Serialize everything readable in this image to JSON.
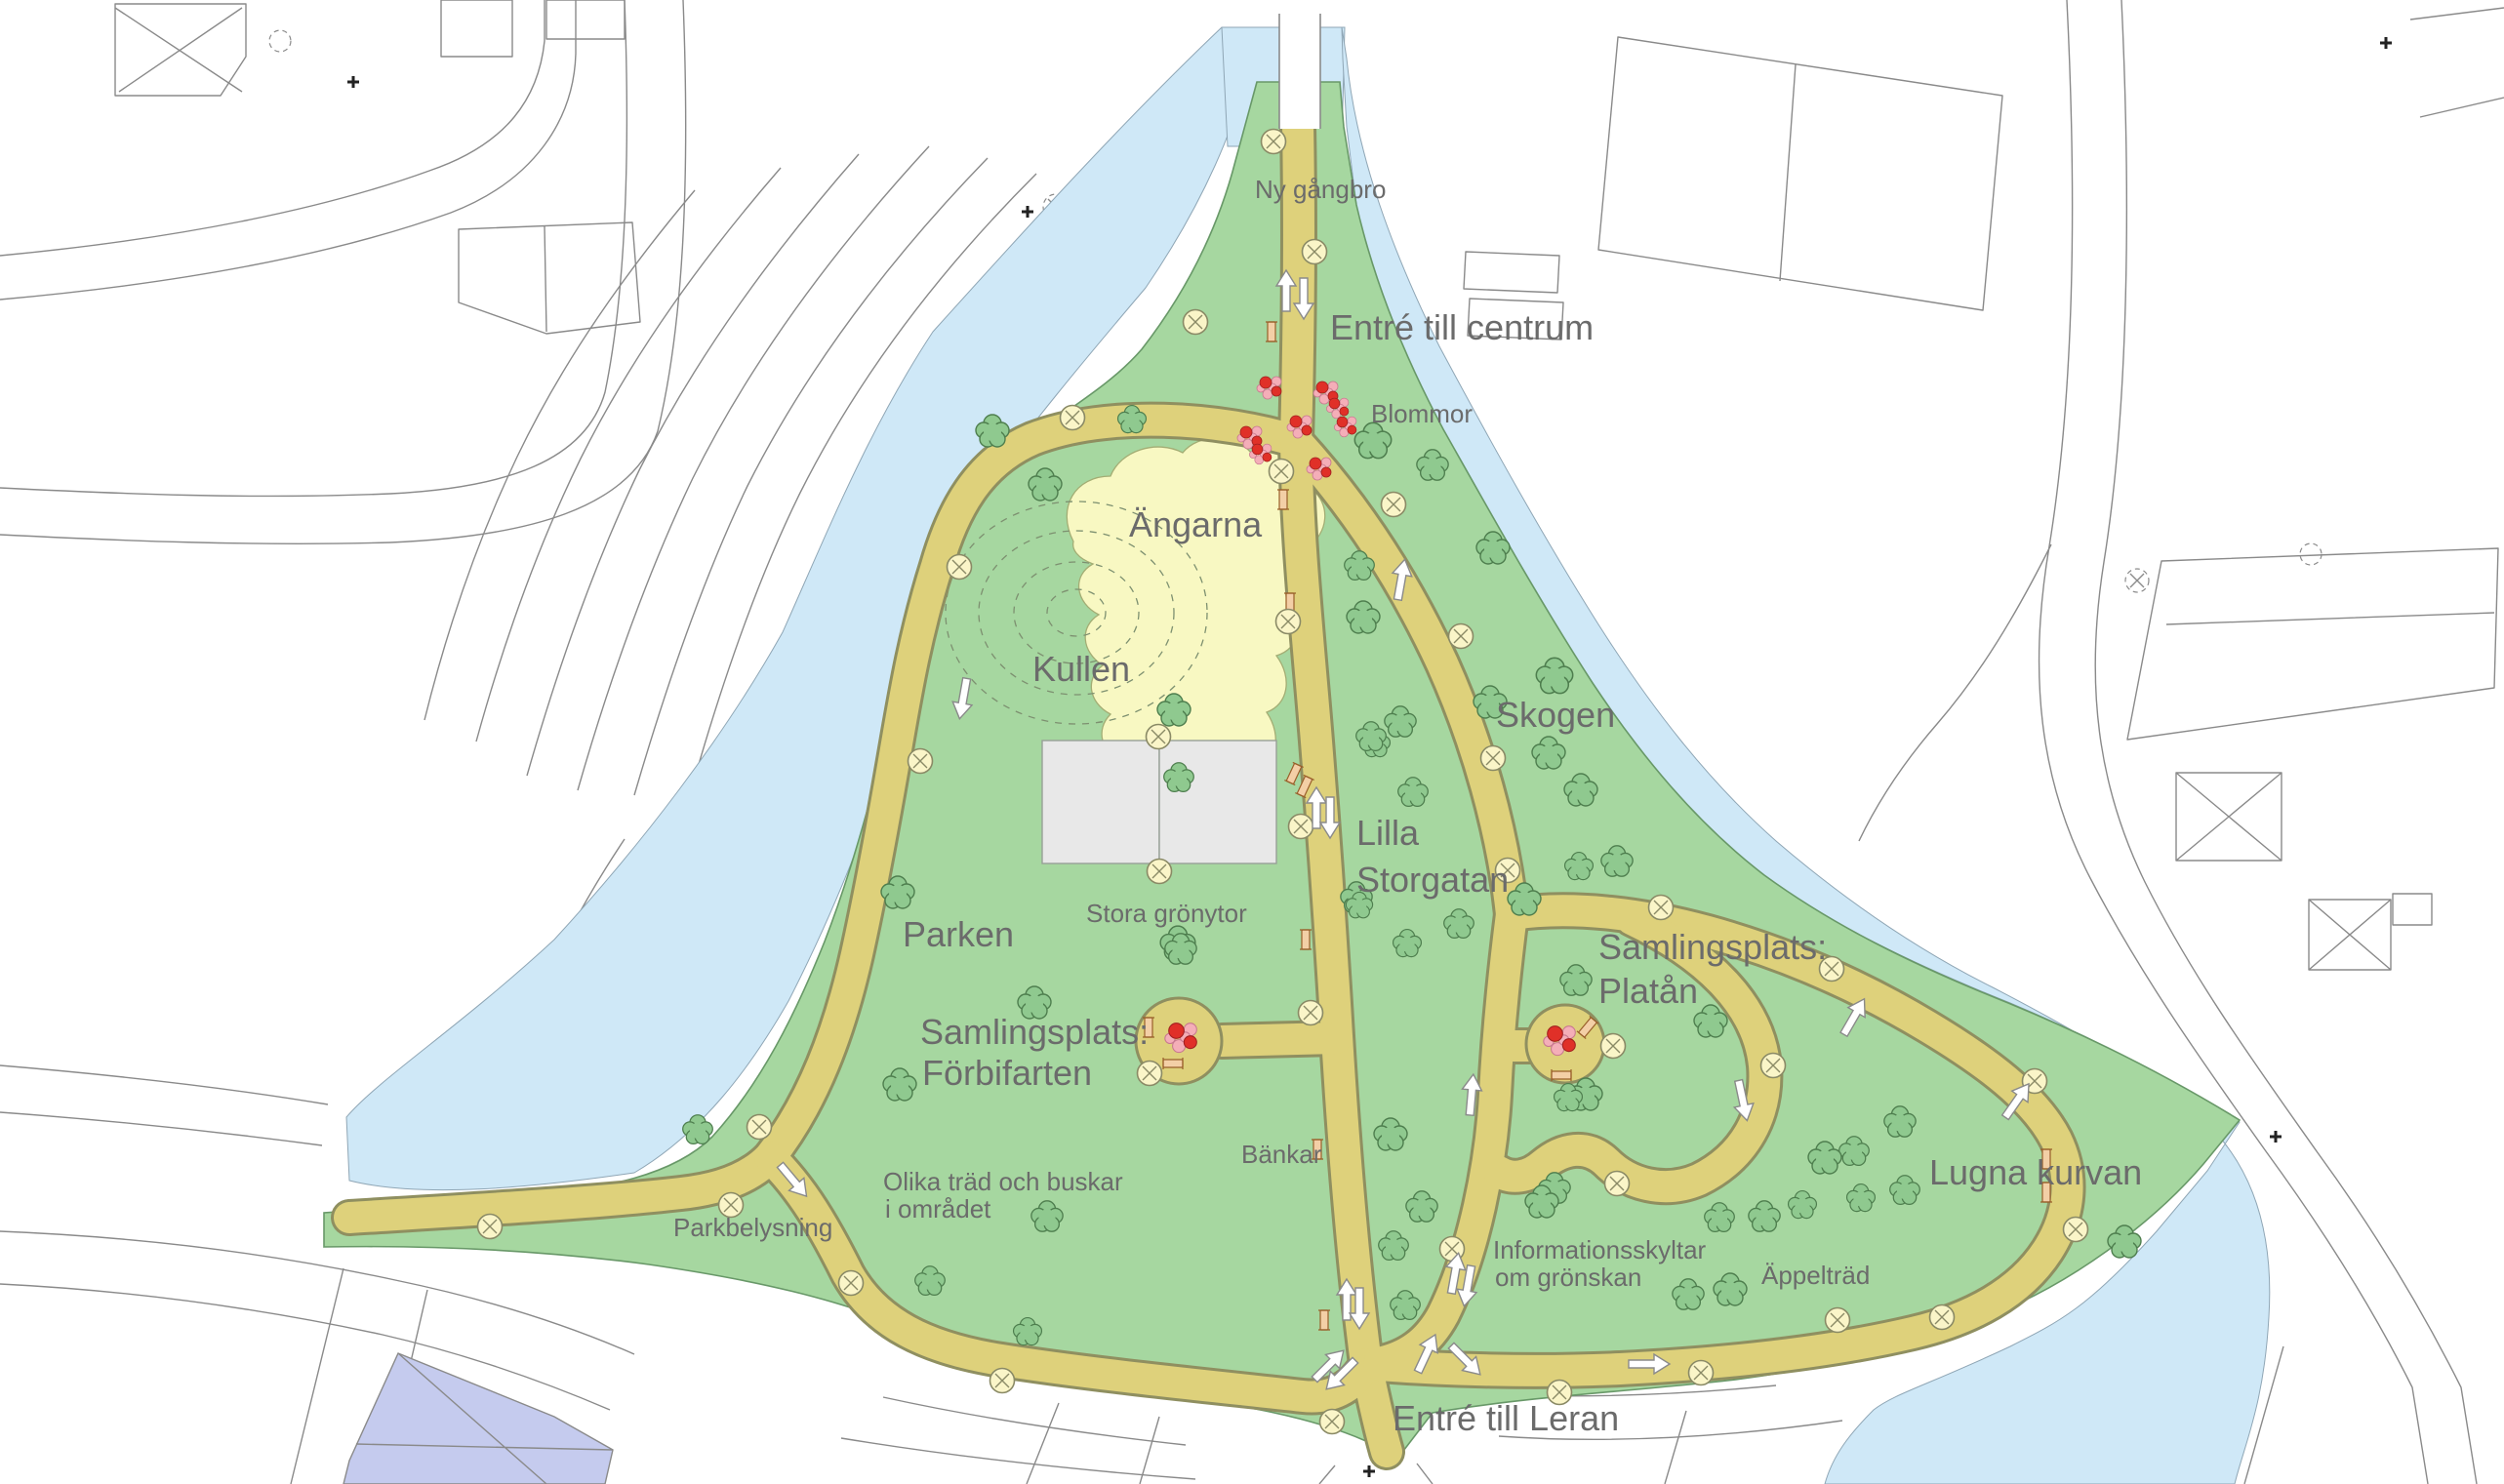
{
  "map": {
    "labels": {
      "ny_gangbro": "Ny gångbro",
      "entre_centrum": "Entré till centrum",
      "blommor": "Blommor",
      "angarna": "Ängarna",
      "kullen": "Kullen",
      "skogen": "Skogen",
      "lilla_storgatan_1": "Lilla",
      "lilla_storgatan_2": "Storgatan",
      "parken": "Parken",
      "stora_gronytor": "Stora grönytor",
      "samlingsplats_forbifarten_1": "Samlingsplats:",
      "samlingsplats_forbifarten_2": "Förbifarten",
      "samlingsplats_platan_1": "Samlingsplats:",
      "samlingsplats_platan_2": "Platån",
      "bankar": "Bänkar",
      "lugna_kurvan": "Lugna kurvan",
      "parkbelysning": "Parkbelysning",
      "olika_trad_1": "Olika träd och buskar",
      "olika_trad_2": "i området",
      "informationsskyltar_1": "Informationsskyltar",
      "informationsskyltar_2": "om grönskan",
      "appeltrad": "Äppelträd",
      "entre_leran": "Entré till Leran"
    },
    "colors": {
      "park": "#a6d7a0",
      "water": "#cfe8f7",
      "path": "#ded17b",
      "path_casing": "#8f8f60",
      "meadow": "#f8f8c2",
      "tree": "#8fc98f",
      "flower_red": "#e03028",
      "flower_pink": "#f4aeb8",
      "lamp": "#faf5c8",
      "label": "#6b6b6b",
      "building_gray": "#e8e8e8",
      "building_purple": "#c5cbee",
      "linework": "#8a8a8a"
    },
    "features": {
      "trees": [
        [
          1017,
          442,
          1.0
        ],
        [
          1071,
          497,
          1.0
        ],
        [
          1160,
          430,
          0.85
        ],
        [
          1203,
          728,
          1.0
        ],
        [
          1208,
          797,
          0.9
        ],
        [
          1407,
          452,
          1.1
        ],
        [
          1468,
          477,
          0.95
        ],
        [
          1530,
          562,
          1.0
        ],
        [
          1393,
          580,
          0.9
        ],
        [
          1397,
          633,
          1.0
        ],
        [
          1527,
          720,
          1.0
        ],
        [
          1593,
          693,
          1.1
        ],
        [
          1435,
          740,
          0.95
        ],
        [
          1410,
          762,
          0.85
        ],
        [
          1587,
          772,
          1.0
        ],
        [
          1448,
          812,
          0.9
        ],
        [
          1620,
          810,
          1.0
        ],
        [
          1657,
          883,
          0.95
        ],
        [
          1618,
          888,
          0.85
        ],
        [
          1562,
          922,
          1.0
        ],
        [
          1495,
          947,
          0.9
        ],
        [
          1390,
          920,
          0.95
        ],
        [
          1442,
          967,
          0.85
        ],
        [
          1405,
          755,
          0.9
        ],
        [
          1393,
          928,
          0.8
        ],
        [
          1207,
          967,
          1.05
        ],
        [
          920,
          915,
          1.0
        ],
        [
          1210,
          973,
          0.95
        ],
        [
          1060,
          1028,
          1.0
        ],
        [
          922,
          1112,
          1.0
        ],
        [
          1615,
          1005,
          0.95
        ],
        [
          1753,
          1047,
          1.0
        ],
        [
          1625,
          1122,
          1.0
        ],
        [
          1947,
          1150,
          0.95
        ],
        [
          1900,
          1180,
          0.9
        ],
        [
          1952,
          1220,
          0.9
        ],
        [
          1593,
          1218,
          0.95
        ],
        [
          1607,
          1125,
          0.85
        ],
        [
          1425,
          1163,
          1.0
        ],
        [
          1870,
          1187,
          1.0
        ],
        [
          1457,
          1237,
          0.95
        ],
        [
          1580,
          1232,
          1.0
        ],
        [
          1808,
          1247,
          0.95
        ],
        [
          1428,
          1277,
          0.9
        ],
        [
          1907,
          1228,
          0.85
        ],
        [
          1440,
          1338,
          0.9
        ],
        [
          1773,
          1322,
          1.0
        ],
        [
          2177,
          1273,
          1.0
        ],
        [
          1762,
          1248,
          0.9
        ],
        [
          1847,
          1235,
          0.85
        ],
        [
          1730,
          1327,
          0.95
        ],
        [
          715,
          1158,
          0.9
        ],
        [
          1073,
          1247,
          0.95
        ],
        [
          953,
          1313,
          0.9
        ],
        [
          1053,
          1365,
          0.85
        ]
      ],
      "lamps": [
        [
          1305,
          145
        ],
        [
          1347,
          258
        ],
        [
          1225,
          330
        ],
        [
          1313,
          483
        ],
        [
          1428,
          517
        ],
        [
          1320,
          637
        ],
        [
          1497,
          652
        ],
        [
          1099,
          428
        ],
        [
          983,
          581
        ],
        [
          943,
          780
        ],
        [
          1187,
          755
        ],
        [
          1188,
          893
        ],
        [
          1333,
          847
        ],
        [
          1343,
          1038
        ],
        [
          1178,
          1100
        ],
        [
          1530,
          777
        ],
        [
          1545,
          892
        ],
        [
          1702,
          930
        ],
        [
          1877,
          993
        ],
        [
          1817,
          1092
        ],
        [
          1653,
          1072
        ],
        [
          1657,
          1213
        ],
        [
          1488,
          1280
        ],
        [
          2085,
          1108
        ],
        [
          2127,
          1260
        ],
        [
          1990,
          1350
        ],
        [
          1883,
          1353
        ],
        [
          1743,
          1407
        ],
        [
          1598,
          1427
        ],
        [
          1365,
          1457
        ],
        [
          1027,
          1415
        ],
        [
          872,
          1315
        ],
        [
          749,
          1235
        ],
        [
          778,
          1155
        ],
        [
          502,
          1257
        ]
      ],
      "benches": [
        [
          1303,
          340,
          0
        ],
        [
          1315,
          512,
          0
        ],
        [
          1322,
          618,
          0
        ],
        [
          1326,
          793,
          25
        ],
        [
          1337,
          806,
          25
        ],
        [
          1338,
          963,
          0
        ],
        [
          1177,
          1053,
          0
        ],
        [
          1350,
          1178,
          0
        ],
        [
          1202,
          1090,
          90
        ],
        [
          1627,
          1053,
          40
        ],
        [
          1600,
          1102,
          90
        ],
        [
          2097,
          1188,
          0
        ],
        [
          2097,
          1222,
          0
        ],
        [
          1357,
          1353,
          0
        ]
      ],
      "arrows": [
        [
          1318,
          298,
          0
        ],
        [
          1336,
          306,
          180
        ],
        [
          1436,
          594,
          10
        ],
        [
          987,
          716,
          190
        ],
        [
          1349,
          828,
          0
        ],
        [
          1363,
          838,
          180
        ],
        [
          1508,
          1122,
          5
        ],
        [
          1491,
          1305,
          10
        ],
        [
          1504,
          1318,
          190
        ],
        [
          1786,
          1128,
          168
        ],
        [
          1380,
          1332,
          0
        ],
        [
          1393,
          1341,
          180
        ],
        [
          1362,
          1399,
          45
        ],
        [
          1374,
          1409,
          225
        ],
        [
          1462,
          1387,
          25
        ],
        [
          1502,
          1394,
          135
        ],
        [
          1690,
          1398,
          90
        ],
        [
          1900,
          1042,
          30
        ],
        [
          2067,
          1128,
          35
        ],
        [
          813,
          1210,
          140
        ]
      ],
      "flowers": [
        [
          1302,
          397,
          1
        ],
        [
          1360,
          402,
          1
        ],
        [
          1372,
          418,
          0.9
        ],
        [
          1333,
          437,
          1
        ],
        [
          1380,
          437,
          0.9
        ],
        [
          1282,
          448,
          1
        ],
        [
          1293,
          465,
          0.9
        ],
        [
          1353,
          480,
          1
        ],
        [
          1212,
          1063,
          1.3
        ],
        [
          1600,
          1066,
          1.3
        ]
      ]
    }
  }
}
